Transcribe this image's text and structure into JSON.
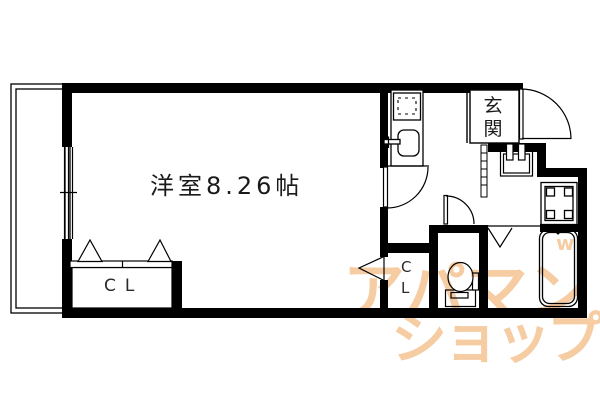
{
  "floorplan": {
    "room_label": "洋室8.26帖",
    "entrance_label": "玄関",
    "closet_main_label": "CL",
    "closet_hall_label": "CL",
    "watermark": {
      "line1": "アパマン",
      "line2": "ショップ",
      "mark": "w",
      "color": "#ee9d4e"
    },
    "colors": {
      "line": "#000000",
      "background": "#ffffff"
    }
  }
}
